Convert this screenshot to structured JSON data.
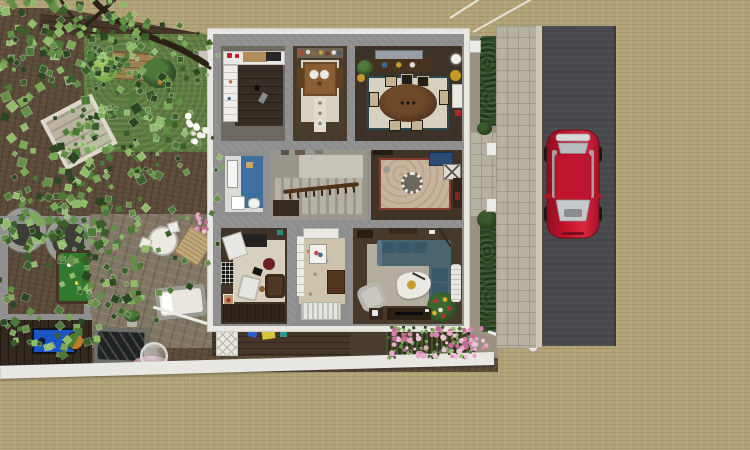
{
  "scene": {
    "description": "Aerial dollhouse cutaway view of a furnished single-family house lot: nine ground-floor rooms, back garden with large overhanging tree, pergola, patio, front flower bed, side hedge with gate, sidewalk and vertical street with a parked red car on sandy terrain",
    "view": "top-down 3d render",
    "visible_text": "none"
  },
  "palette": {
    "terrain": "#b1a277",
    "road": "#46484b",
    "curb": "#cdc7b6",
    "sidewalk": "#b7b1a2",
    "paver_line": "#9f998b",
    "house_wall": "#e9e7e1",
    "inner_wall": "#8e8e8e",
    "dirt": "#5c4b39",
    "lawn": "#5e7c40",
    "patio_stone": "#817563",
    "deck_brown": "#453629",
    "shed_floor": "#32281e",
    "hedge": "#2d4a24",
    "car_red": "#c4122c",
    "car_red_dark": "#8e1022",
    "glass_grey": "#c3c6c9",
    "sofa_teal": "#4b6570",
    "cushion_blue": "#39596a",
    "bath_blue": "#3e6f9e",
    "rug_cream": "#d7d1c0",
    "rug_border_teal": "#2c4850",
    "entry_rug": "#c7b59e",
    "console_blue": "#2c4a74",
    "pool_green": "#2f7a2f",
    "bench_blue": "#1a55c8",
    "flower_pink": "#e8a8c8",
    "gold": "#c59d2a",
    "white_trim": "#eceae4",
    "radiator_white": "#e7e5df"
  },
  "rooms": [
    {
      "id": "kitchen",
      "furniture": [
        "upper-cabinets",
        "wood-counter",
        "cooktop",
        "red-appliances",
        "fridge-pantry-unit",
        "pendant-lamp"
      ]
    },
    {
      "id": "breakfast-room",
      "furniture": [
        "wall-shelf-jars",
        "wood-table",
        "plates",
        "chairs",
        "runner-rug"
      ]
    },
    {
      "id": "dining-room",
      "furniture": [
        "wall-art",
        "sideboard",
        "potted-palm",
        "sphere-floor-lamp",
        "gold-drum-stool",
        "white-cabinet",
        "oval-table",
        "six-chairs",
        "bordered-rug"
      ]
    },
    {
      "id": "bathroom",
      "furniture": [
        "mirror",
        "sink",
        "blue-accent-wall",
        "toilet"
      ]
    },
    {
      "id": "stair-hall",
      "furniture": [
        "staircase",
        "wood-banister",
        "picture-frames"
      ]
    },
    {
      "id": "entry-hall",
      "furniture": [
        "medallion-rug",
        "blue-console-table",
        "x-side-table",
        "ceiling-lamp"
      ]
    },
    {
      "id": "study",
      "furniture": [
        "desk",
        "drafting-board",
        "burgundy-pouf",
        "white-lounge-chair",
        "brown-armchair",
        "teddy-bear",
        "trellis-window",
        "black-lamp"
      ]
    },
    {
      "id": "mud-room",
      "furniture": [
        "french-window-strip",
        "floral-carpet",
        "flower-picture",
        "dresser",
        "radiator"
      ]
    },
    {
      "id": "living-room",
      "furniture": [
        "l-shaped-teal-sectional",
        "organic-coffee-table",
        "gold-tray",
        "arc-lamp",
        "pale-armchair",
        "festive-potted-tree",
        "media-console",
        "espresso-side-table",
        "white-chaise"
      ]
    }
  ],
  "outdoor_objects": [
    "large-tree",
    "tree-branches",
    "deck-path",
    "lawn",
    "raised-garden-bed",
    "light-bush",
    "dark-bush",
    "grey-pot",
    "white-flower-cluster",
    "pergola",
    "round-planters",
    "veranda-frame",
    "outdoor-pool-table",
    "patio-table-set",
    "wood-lounger",
    "daybed",
    "potted-plant",
    "cold-frame-panel",
    "gazing-sphere",
    "pink-mat",
    "shed",
    "blue-workbench",
    "barrel",
    "porch-stair-rail",
    "lattice-skirt",
    "garden-toys",
    "front-flower-bed",
    "white-fence-segment",
    "gate-rail-with-ball-cap",
    "boundary-wall",
    "side-hedge",
    "gate-posts",
    "front-walk",
    "sidewalk",
    "curb",
    "road",
    "red-car",
    "power-lines"
  ],
  "street": {
    "car_color": "#c4122c",
    "car_orientation": "nose-down",
    "road_orientation": "vertical",
    "lane_markings": "none"
  },
  "foliage": {
    "seed": 42,
    "palettes": {
      "leaf": [
        "#2c4722",
        "#3c5e2d",
        "#4e7a39",
        "#648f46",
        "#7ca957",
        "#90bc6a"
      ],
      "pink": [
        "#e8a8c8",
        "#d884ae",
        "#f0c0d8",
        "#c86a96"
      ],
      "white": [
        "#f2f2ea",
        "#e4e6da",
        "#ffffff"
      ]
    },
    "regions": [
      {
        "name": "canopy-core",
        "type": "ellipse",
        "glyph": "rect",
        "cx": 55,
        "cy": 120,
        "rx": 115,
        "ry": 150,
        "count": 240,
        "min": 4,
        "max": 9,
        "palette": "leaf"
      },
      {
        "name": "canopy-top",
        "type": "ellipse",
        "glyph": "rect",
        "cx": 62,
        "cy": 36,
        "rx": 88,
        "ry": 46,
        "count": 110,
        "min": 4,
        "max": 8,
        "palette": "leaf"
      },
      {
        "name": "canopy-low",
        "type": "ellipse",
        "glyph": "rect",
        "cx": 58,
        "cy": 268,
        "rx": 95,
        "ry": 88,
        "count": 150,
        "min": 4,
        "max": 8,
        "palette": "leaf"
      },
      {
        "name": "spread-mid",
        "type": "ellipse",
        "glyph": "rect",
        "cx": 142,
        "cy": 205,
        "rx": 88,
        "ry": 120,
        "count": 85,
        "min": 3,
        "max": 7,
        "palette": "leaf"
      },
      {
        "name": "arm-right",
        "type": "ellipse",
        "glyph": "rect",
        "cx": 150,
        "cy": 56,
        "rx": 68,
        "ry": 36,
        "count": 55,
        "min": 3,
        "max": 6,
        "palette": "leaf"
      },
      {
        "name": "over-lawn",
        "type": "ellipse",
        "glyph": "rect",
        "cx": 132,
        "cy": 122,
        "rx": 62,
        "ry": 56,
        "count": 48,
        "min": 3,
        "max": 6,
        "palette": "leaf"
      },
      {
        "name": "flowerbed-green",
        "type": "rect",
        "glyph": "rect",
        "x": 388,
        "y": 327,
        "w": 88,
        "h": 31,
        "count": 80,
        "min": 2,
        "max": 4,
        "palette": "leaf"
      },
      {
        "name": "flowerbed-pink",
        "type": "rect",
        "glyph": "circle",
        "x": 390,
        "y": 328,
        "w": 86,
        "h": 29,
        "count": 60,
        "min": 1.5,
        "max": 3,
        "palette": "pink"
      },
      {
        "name": "white-flowers",
        "type": "ellipse",
        "glyph": "circle",
        "cx": 193,
        "cy": 128,
        "rx": 13,
        "ry": 18,
        "count": 12,
        "min": 2,
        "max": 3.5,
        "palette": "white"
      },
      {
        "name": "roses-west-wall",
        "type": "rect",
        "glyph": "circle",
        "x": 196,
        "y": 214,
        "w": 14,
        "h": 20,
        "count": 10,
        "min": 1.5,
        "max": 2.5,
        "palette": "pink"
      },
      {
        "name": "fence-corner-flowers",
        "type": "rect",
        "glyph": "circle",
        "x": 470,
        "y": 328,
        "w": 18,
        "h": 22,
        "count": 12,
        "min": 1.5,
        "max": 2.5,
        "palette": "pink"
      }
    ]
  }
}
